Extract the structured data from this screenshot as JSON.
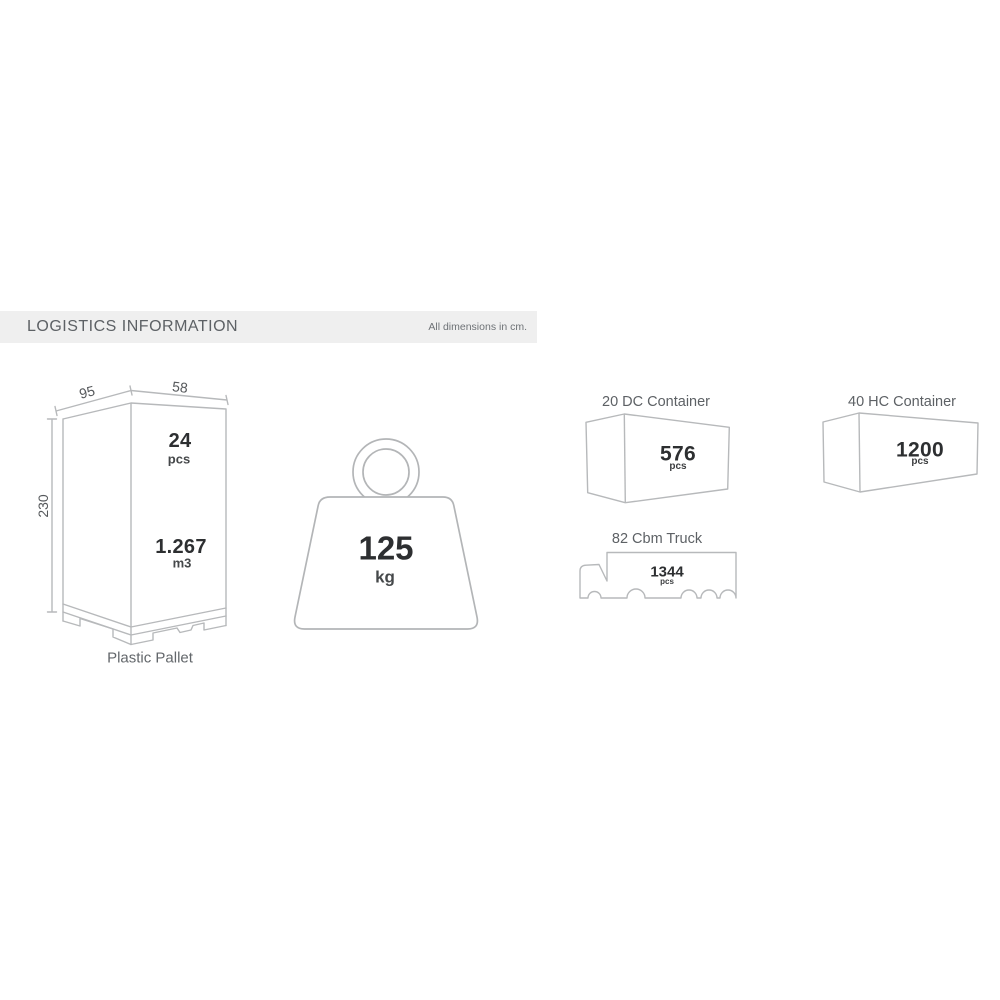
{
  "header": {
    "title": "LOGISTICS INFORMATION",
    "note": "All dimensions in cm."
  },
  "pallet": {
    "width_cm": "95",
    "depth_cm": "58",
    "height_cm": "230",
    "pieces": "24",
    "pieces_unit": "pcs",
    "volume": "1.267",
    "volume_unit": "m3",
    "caption": "Plastic Pallet"
  },
  "weight": {
    "value": "125",
    "unit": "kg"
  },
  "containers": [
    {
      "title": "20 DC Container",
      "pieces": "576",
      "unit": "pcs"
    },
    {
      "title": "40 HC Container",
      "pieces": "1200",
      "unit": "pcs"
    }
  ],
  "truck": {
    "title": "82 Cbm Truck",
    "pieces": "1344",
    "unit": "pcs"
  },
  "colors": {
    "line": "#b7b9bb",
    "number": "#2d2f31",
    "label": "#45484a",
    "title": "#5d6165",
    "header_bg": "#efefef"
  }
}
